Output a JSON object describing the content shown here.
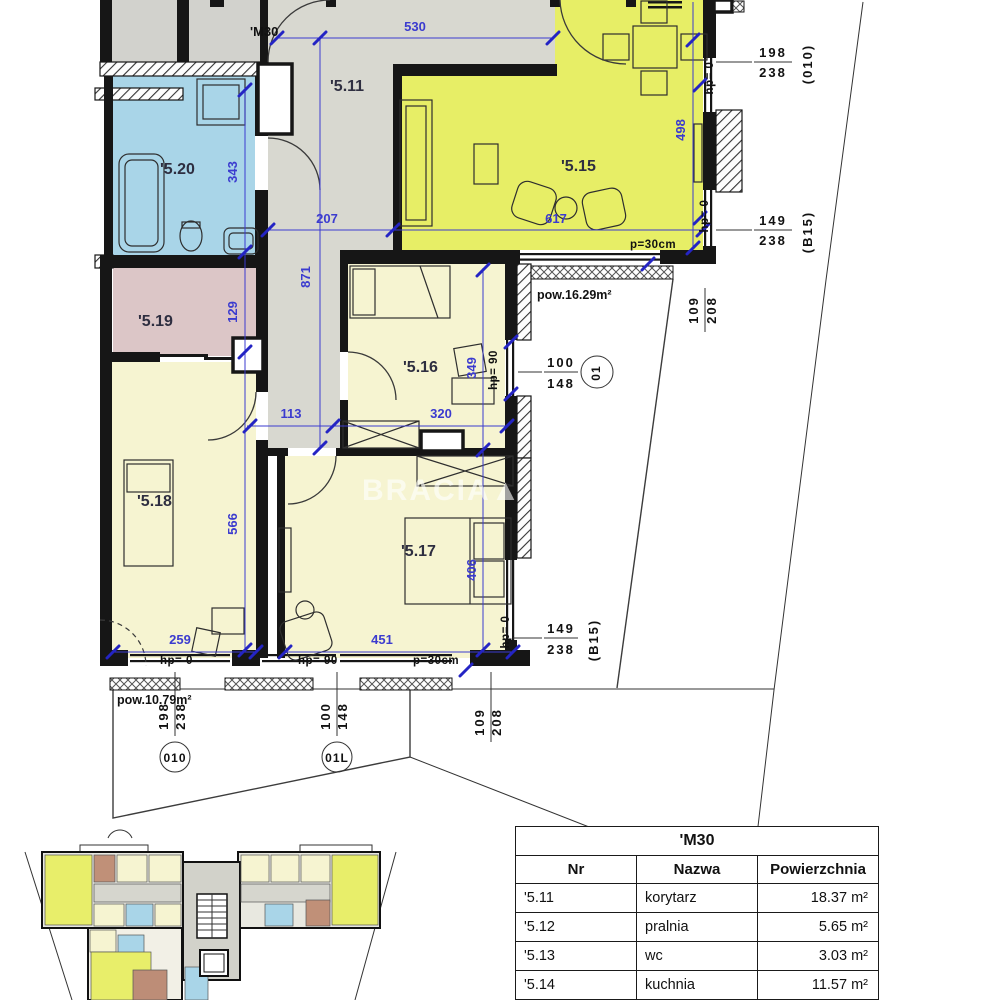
{
  "plan": {
    "apartment_label": "'M30",
    "rooms": {
      "r5_11": "'5.11",
      "r5_15": "'5.15",
      "r5_16": "'5.16",
      "r5_17": "'5.17",
      "r5_18": "'5.18",
      "r5_19": "'5.19",
      "r5_20": "'5.20"
    },
    "dims": {
      "d530": "530",
      "d343": "343",
      "d129": "129",
      "d566": "566",
      "d871": "871",
      "d207": "207",
      "d617": "617",
      "d113": "113",
      "d320": "320",
      "d349": "349",
      "d406": "406",
      "d498": "498",
      "d259": "259",
      "d451": "451"
    },
    "labels": {
      "hp0": "hp= 0",
      "hp90": "hp= 90",
      "p30": "p=30cm",
      "balcony_right_area": "pow.16.29m²",
      "balcony_bottom_area": "pow.10.79m²"
    },
    "tags": {
      "o10_top": {
        "w": "198",
        "h": "238",
        "code": "(010)"
      },
      "b15_right": {
        "w": "149",
        "h": "238",
        "code": "(B15)"
      },
      "o1_right": {
        "w": "100",
        "h": "148",
        "code": "01"
      },
      "b15_bottom": {
        "w": "149",
        "h": "238",
        "code": "(B15)"
      },
      "o10_bottom": {
        "w": "198",
        "h": "238",
        "code": "010"
      },
      "o1l_bottom": {
        "w": "100",
        "h": "148",
        "code": "01L"
      },
      "v109_208_right": {
        "w": "109",
        "h": "208"
      },
      "v109_208_bottom": {
        "w": "109",
        "h": "208"
      }
    }
  },
  "watermark": "BRACIA▲ SA",
  "table": {
    "title": "'M30",
    "columns": [
      "Nr",
      "Nazwa",
      "Powierzchnia"
    ],
    "rows": [
      {
        "nr": "'5.11",
        "nazwa": "korytarz",
        "powierzchnia": "18.37 m²"
      },
      {
        "nr": "'5.12",
        "nazwa": "pralnia",
        "powierzchnia": "5.65 m²"
      },
      {
        "nr": "'5.13",
        "nazwa": "wc",
        "powierzchnia": "3.03 m²"
      },
      {
        "nr": "'5.14",
        "nazwa": "kuchnia",
        "powierzchnia": "11.57 m²"
      },
      {
        "nr": "'5.15",
        "nazwa": "salon",
        "powierzchnia": "26.05 m²"
      }
    ]
  },
  "colors": {
    "dimension_blue": "#3b3bcf",
    "salon_yellow": "#e7ee66",
    "bedroom_cream": "#f6f4d1",
    "bath_blue": "#a9d5e8",
    "wardrobe_pink": "#dcc6c7",
    "corridor_grey": "#d8d8d0"
  }
}
